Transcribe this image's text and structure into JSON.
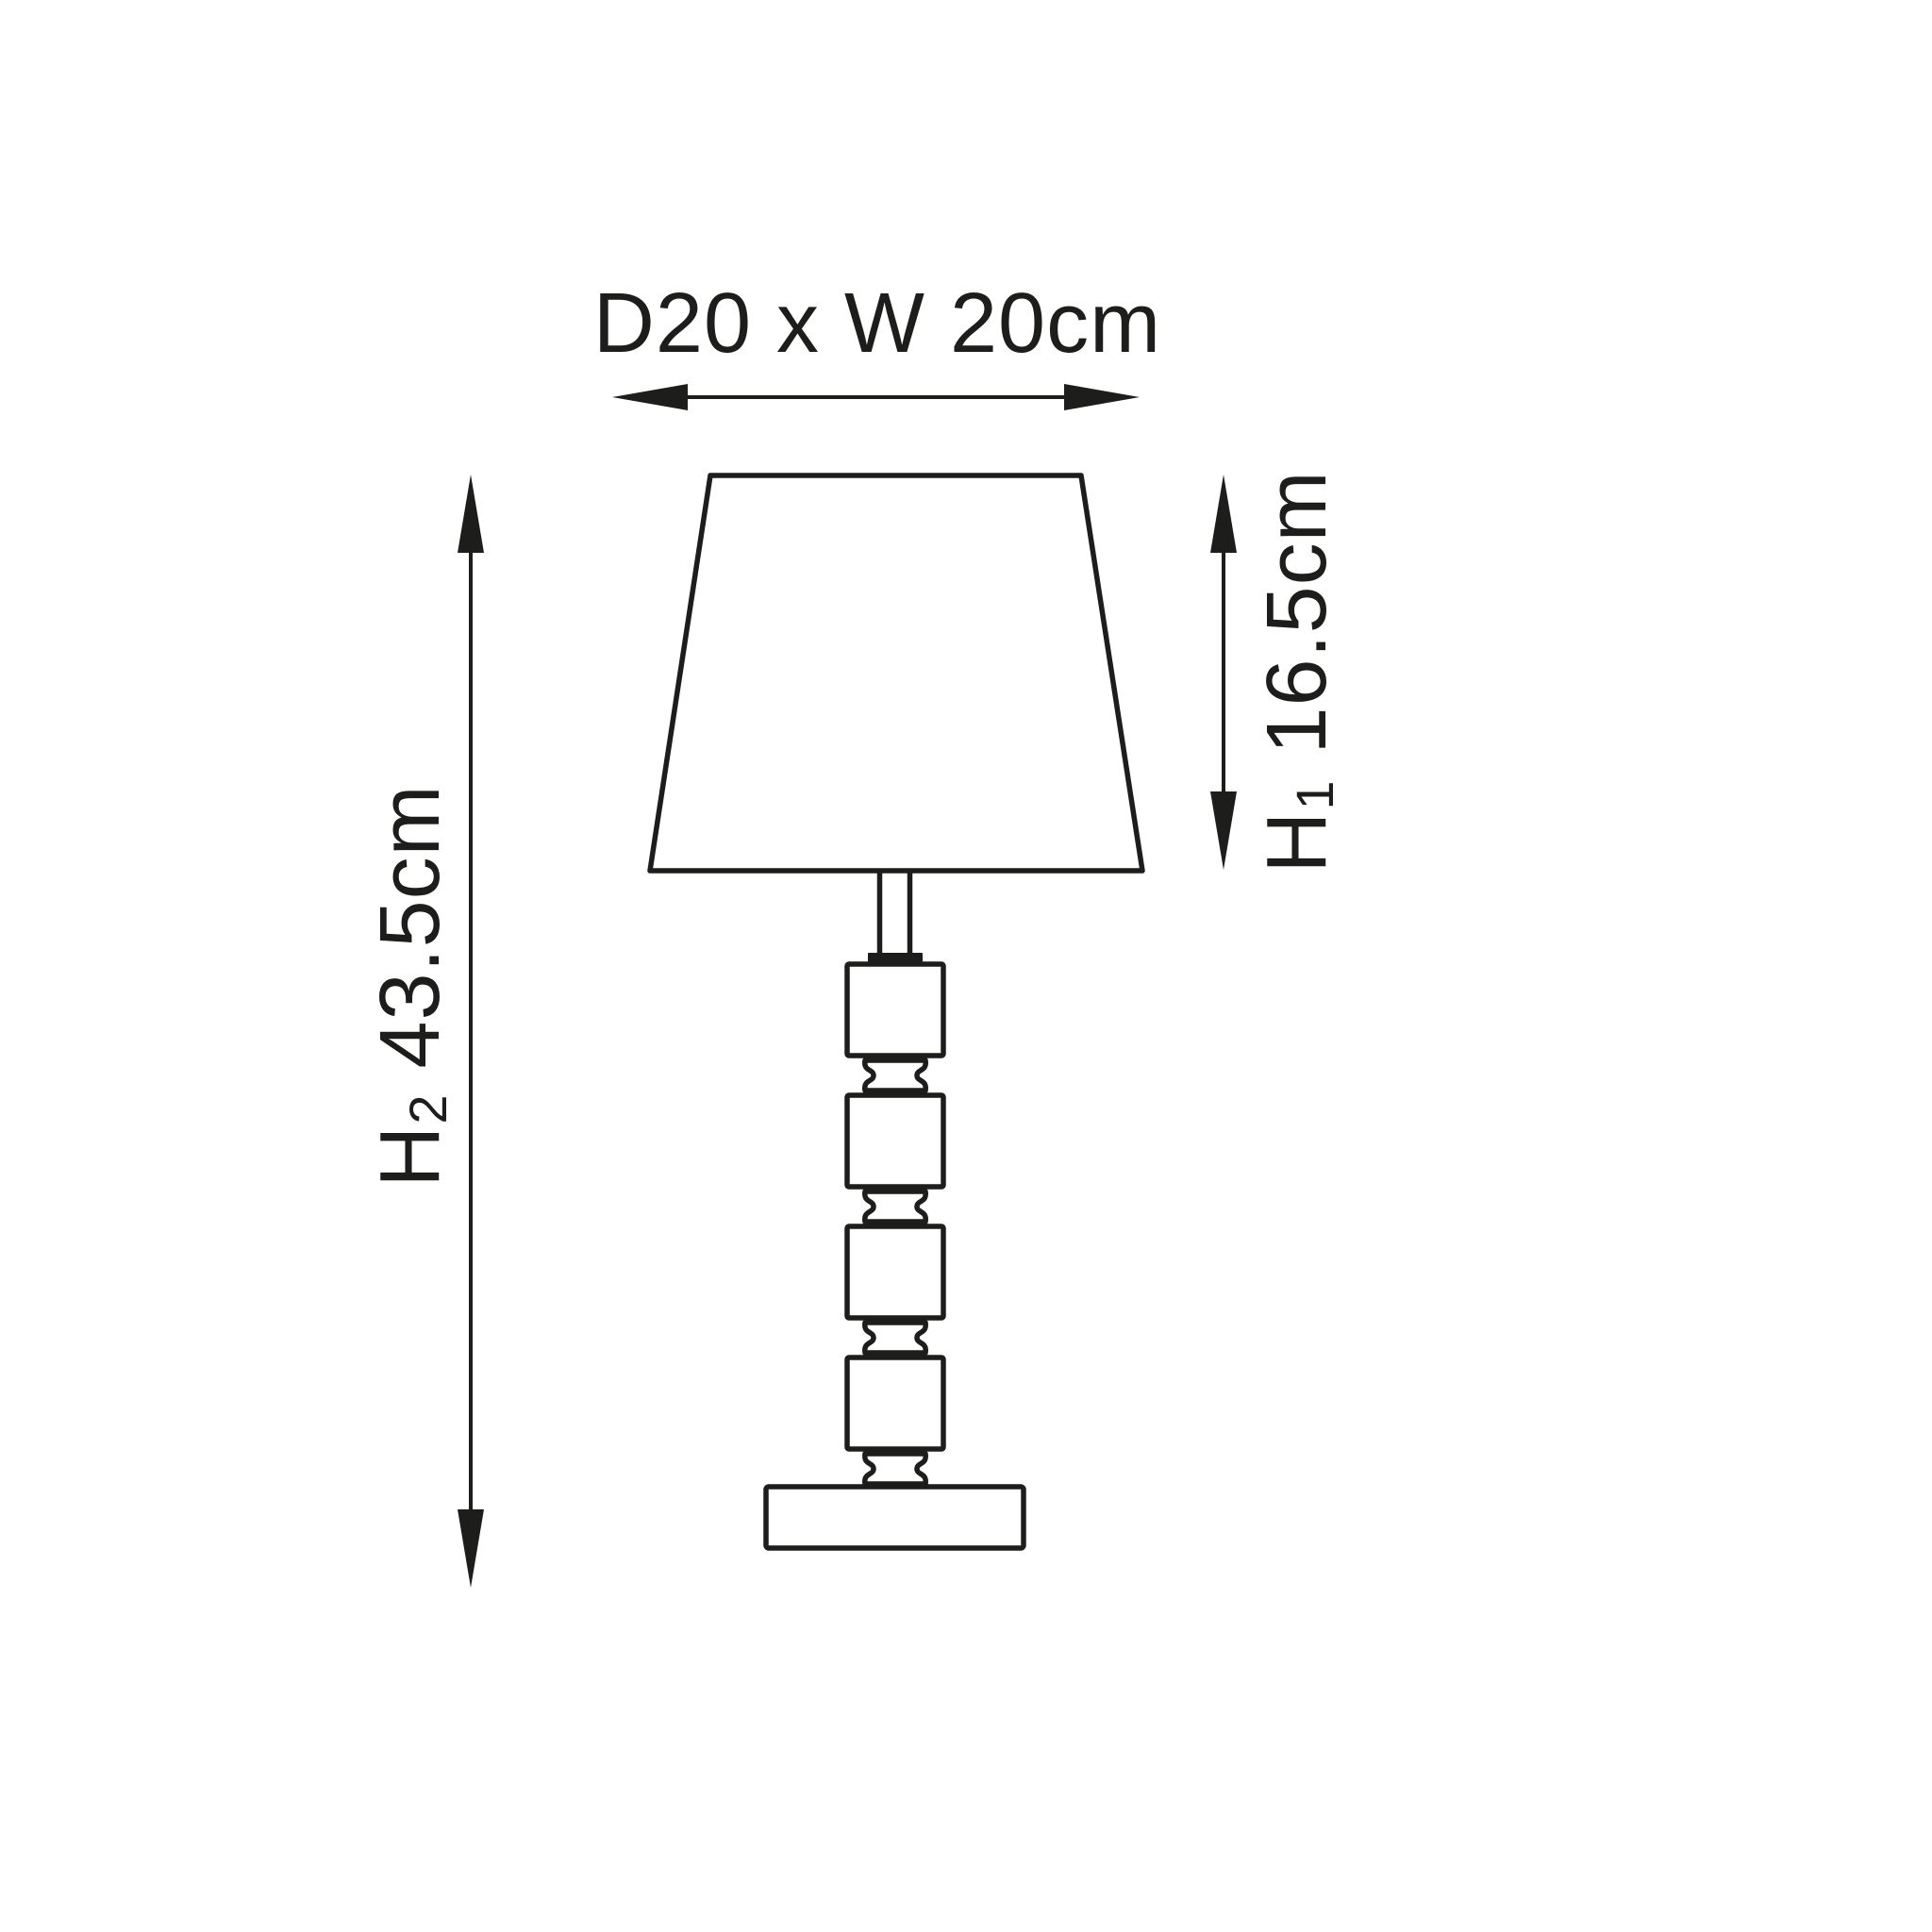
{
  "figure": {
    "type": "dimension-diagram",
    "subject": "table-lamp-line-drawing",
    "ink_color": "#1d1d1b",
    "background_color": "#ffffff"
  },
  "dimensions": {
    "top": {
      "text": "D20 x W 20cm"
    },
    "left": {
      "prefix": "H",
      "sub": "2",
      "value": "43.5cm"
    },
    "right": {
      "prefix": "H",
      "sub": "1",
      "value": "16.5cm"
    }
  }
}
